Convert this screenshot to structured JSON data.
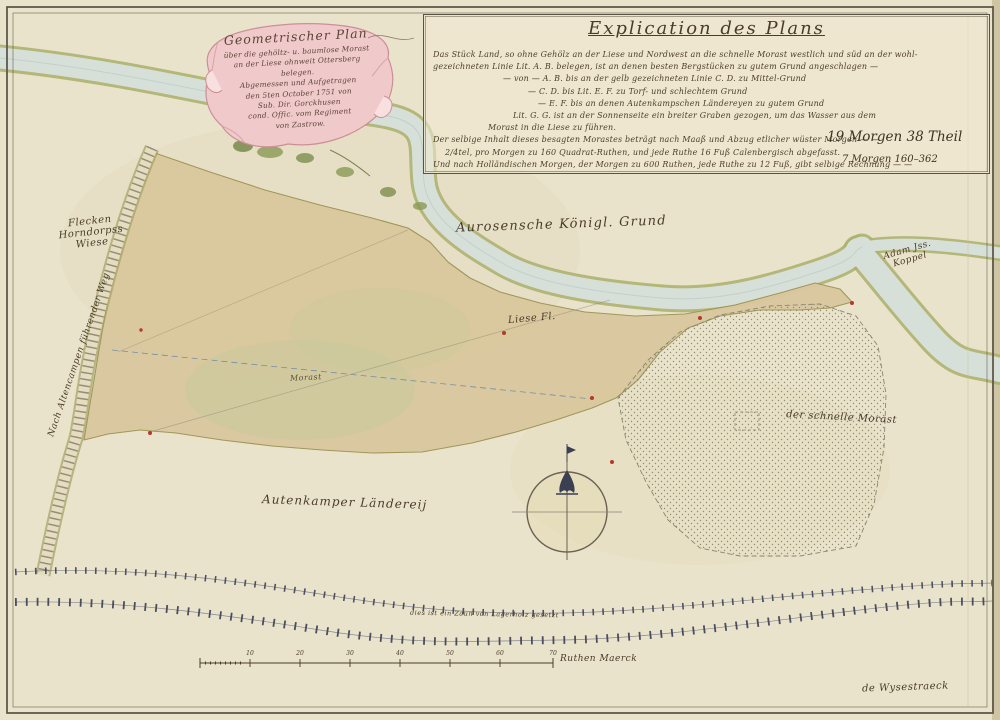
{
  "map": {
    "cartouche": {
      "lines": [
        "Geometrischer Plan",
        "über die gehöltz- u. baumlose Morast",
        "an der Liese ohnweit Ottersberg",
        "belegen.",
        "Abgemessen und Aufgetragen",
        "den 5ten October 1751 von",
        "Sub. Dir. Gorckhusen",
        "cond. Offic. vom Regiment",
        "von Zastrow."
      ]
    },
    "explication": {
      "title": "Explication des Plans",
      "lines": [
        "Das Stück Land, so ohne Gehölz an der Liese und Nordwest an die schnelle Morast westlich und süd an der wohl-",
        "gezeichneten Linie Lit. A. B. belegen, ist an denen besten Bergstücken zu gutem Grund angeschlagen —",
        "— von — A. B. bis an der gelb gezeichneten Linie C. D. zu Mittel-Grund",
        "— C. D. bis Lit. E. F. zu Torf- und schlechtem Grund",
        "— E. F. bis an denen Autenkampschen Ländereyen zu gutem Grund",
        "Lit. G. G. ist an der Sonnenseite ein breiter Graben gezogen, um das Wasser aus dem",
        "Morast in die Liese zu führen.",
        "Der selbige Inhalt dieses besagten Morastes beträgt nach Maaß und Abzug etlicher wüster Morgen — —",
        "2/4tel, pro Morgen zu 160 Quadrat-Ruthen, und jede Ruthe 16 Fuß Calenbergisch abgefasst.",
        "Und nach Holländischen Morgen, der Morgen zu 600 Ruthen, jede Ruthe zu 12 Fuß, gibt selbige Rechnung — —"
      ],
      "value_main": "19 Morgen 38 Theil",
      "value_holl": "7 Morgen 160–362"
    },
    "labels": {
      "wiese_1": "Flecken Horndorpss",
      "wiese_2": "Wiese",
      "dike_road": "Nach Altencampen führender Weg",
      "royal_ground": "Aurosensche Königl. Grund",
      "river": "Liese Fl.",
      "koppel_1": "Adam Jss.",
      "koppel_2": "Koppel",
      "bog_small": "Morast",
      "fast_bog": "der schnelle Morast",
      "farmland": "Autenkamper Ländereij",
      "fence_note": "dies ist ein Zaun von Lagerholz gesetzt",
      "scale_label": "Ruthen Maerck",
      "signature": "de Wysestraeck"
    },
    "scale_ticks": [
      "10",
      "20",
      "30",
      "40",
      "50",
      "60",
      "70"
    ],
    "colors": {
      "paper": "#eae3cb",
      "bog": "#dac89e",
      "water": "#d7e0d8",
      "bank_green": "#a9b06b",
      "ink": "#4a3b2a",
      "cartouche_pink": "#f0c9cb",
      "marker_red": "#b23a2a"
    }
  }
}
